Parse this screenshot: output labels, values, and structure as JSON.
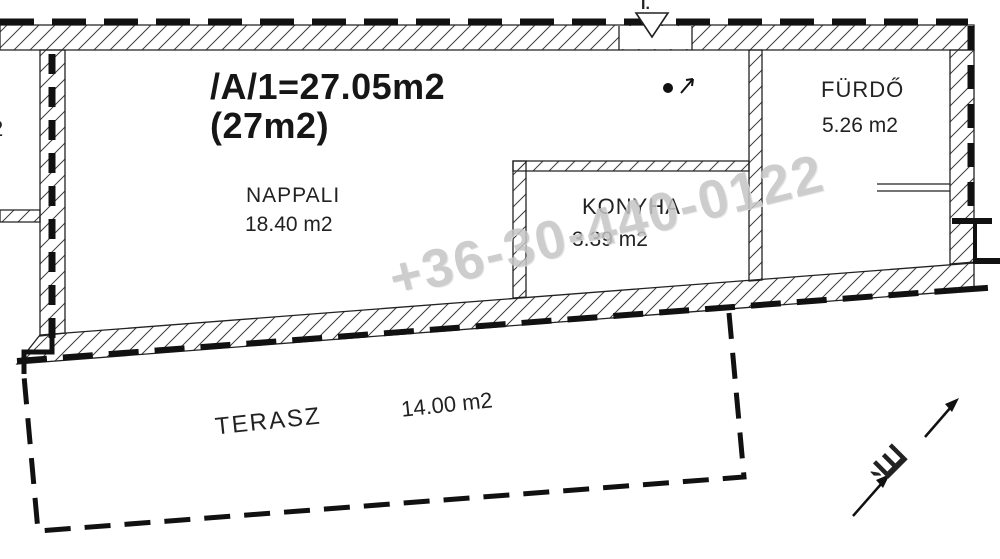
{
  "floor_plan": {
    "title": {
      "line1": "/A/1=27.05m2",
      "line2": "(27m2)"
    },
    "rooms": {
      "nappali": {
        "name": "NAPPALI",
        "area": "18.40 m2"
      },
      "konyha": {
        "name": "KONYHA",
        "area": "3.39 m2"
      },
      "furdo": {
        "name": "FÜRDŐ",
        "area": "5.26 m2"
      },
      "terasz": {
        "name": "TERASZ",
        "area": "14.00 m2"
      }
    },
    "markers": {
      "entrance_label": "I.",
      "north_label": "É",
      "left_edge_label": "2"
    },
    "watermark": "+36-30-440-0122",
    "colors": {
      "line": "#1f1f1f",
      "watermark": "#c5c5c5",
      "background": "#ffffff"
    }
  }
}
